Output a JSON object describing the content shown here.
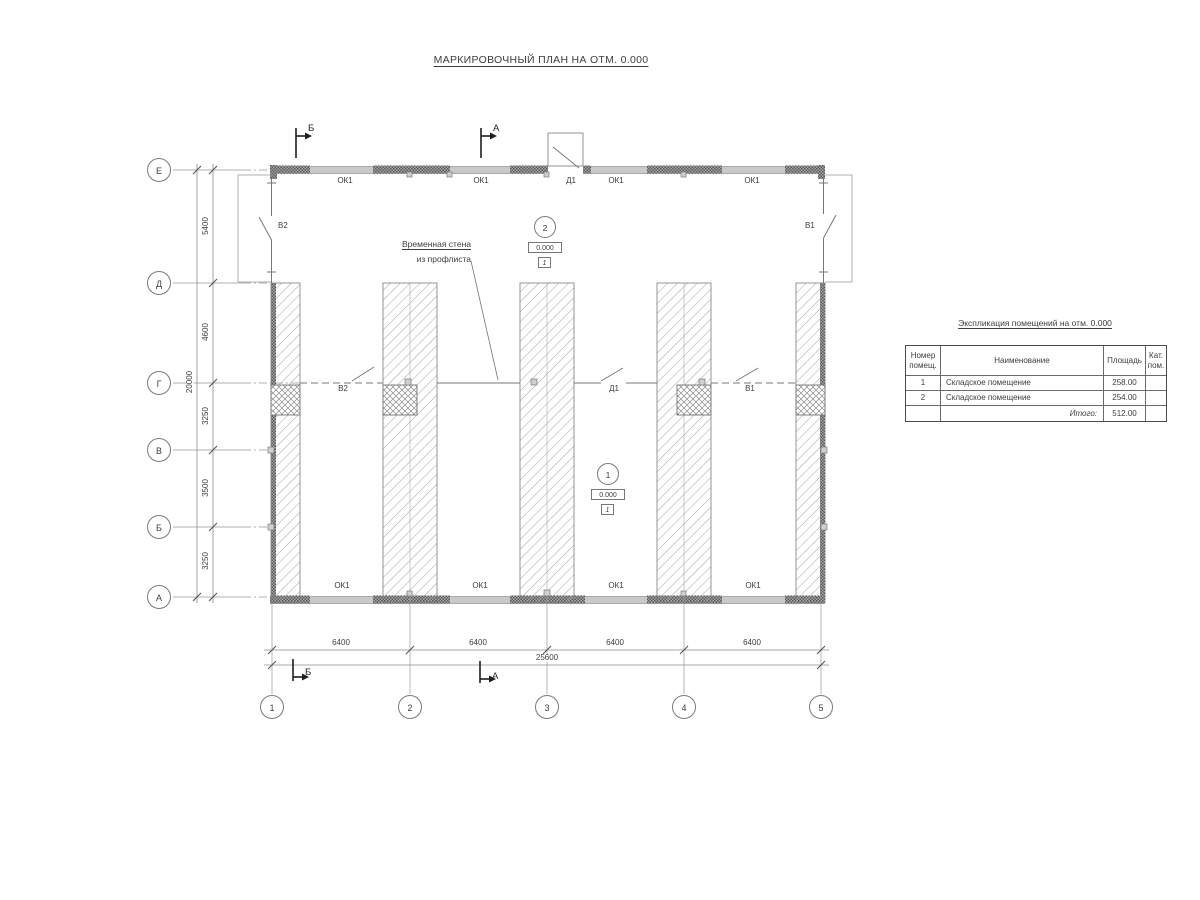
{
  "sheet": {
    "title": "МАРКИРОВОЧНЫЙ ПЛАН НА ОТМ. 0.000"
  },
  "axes": {
    "rows": [
      "Е",
      "Д",
      "Г",
      "В",
      "Б",
      "А"
    ],
    "cols": [
      "1",
      "2",
      "3",
      "4",
      "5"
    ]
  },
  "dimensions": {
    "left_segments": [
      "5400",
      "4600",
      "3250",
      "3500",
      "3250"
    ],
    "left_total": "20000",
    "bottom_segments": [
      "6400",
      "6400",
      "6400",
      "6400"
    ],
    "bottom_total": "25600"
  },
  "labels": {
    "window": "ОК1",
    "door": "Д1",
    "gate_left": "В2",
    "gate_right": "В1"
  },
  "annotation": {
    "line1": "Временная стена",
    "line2": "из профлиста"
  },
  "rooms": [
    {
      "number": "1",
      "elevation": "0.000",
      "floor_type": "1"
    },
    {
      "number": "2",
      "elevation": "0.000",
      "floor_type": "1"
    }
  ],
  "sections": {
    "a": "А",
    "b": "Б"
  },
  "schedule": {
    "title": "Экспликация помещений на отм. 0.000",
    "headers": [
      "Номер помещ.",
      "Наименование",
      "Площадь",
      "Кат. пом."
    ],
    "rows": [
      {
        "number": "1",
        "name": "Складское помещение",
        "area": "258.00",
        "category": ""
      },
      {
        "number": "2",
        "name": "Складское помещение",
        "area": "254.00",
        "category": ""
      }
    ],
    "total_label": "Итого:",
    "total_value": "512.00"
  },
  "colors": {
    "background": "#ffffff",
    "thin_line": "#8c8c8c",
    "wall_dark": "#5f5f5f",
    "window_band": "#c9c9c9",
    "text": "#3d3d3d",
    "section_mark": "#1e1e1e"
  }
}
